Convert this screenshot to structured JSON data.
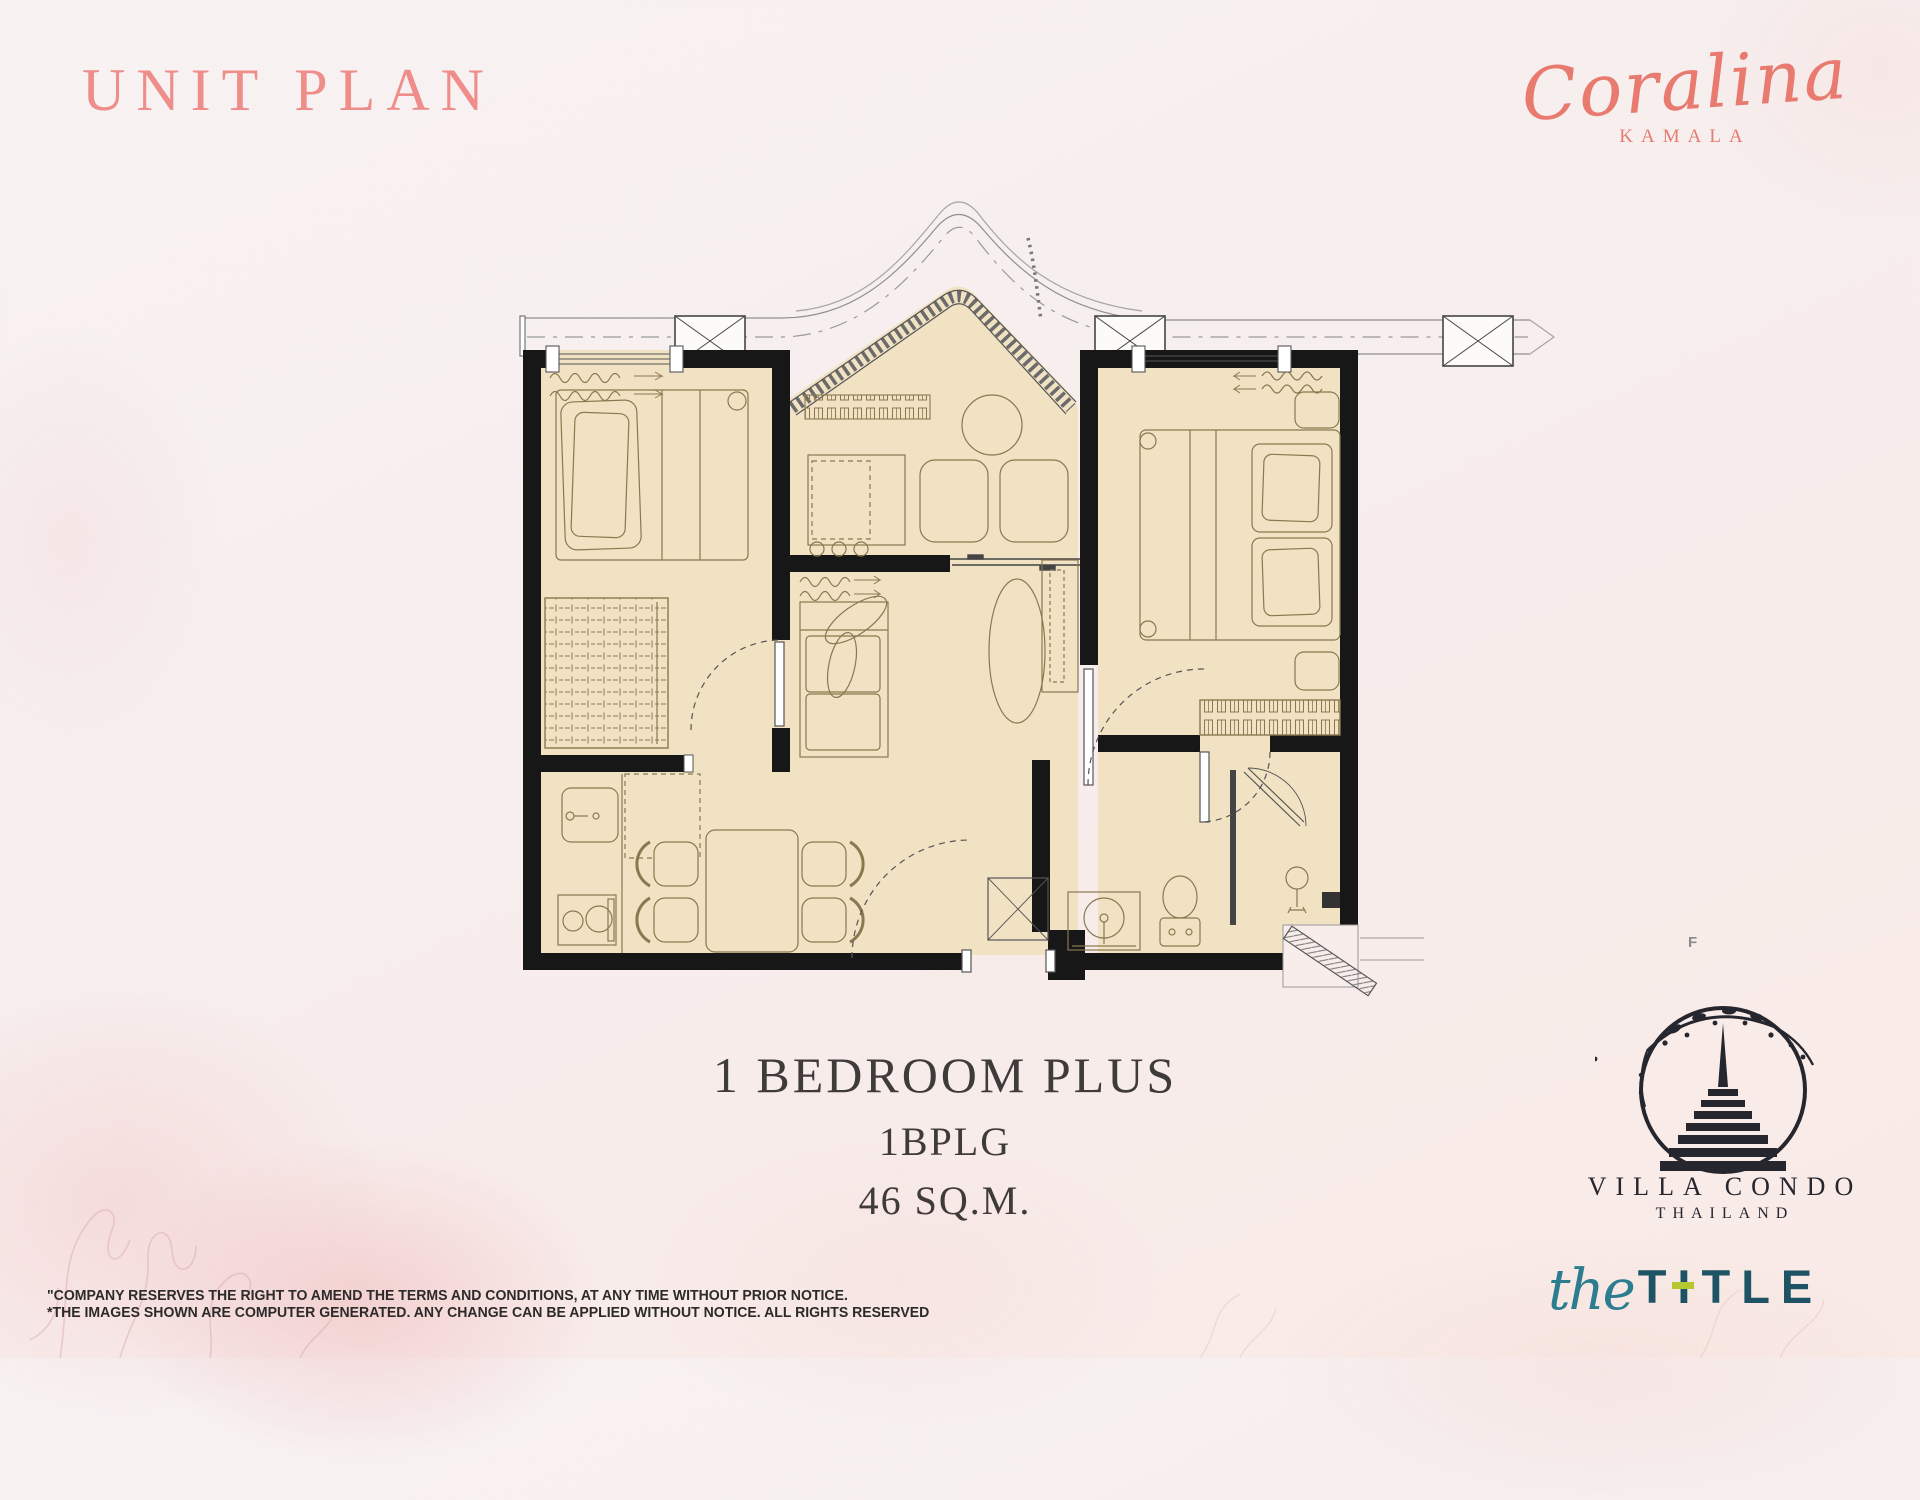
{
  "page": {
    "title_label": "UNIT PLAN",
    "floor_marker": "F"
  },
  "brand": {
    "name": "Coralina",
    "location": "KAMALA"
  },
  "unit": {
    "name": "1 BEDROOM PLUS",
    "code": "1BPLG",
    "area": "46 SQ.M."
  },
  "disclaimer": {
    "line1": "\"COMPANY RESERVES THE RIGHT TO AMEND THE TERMS AND CONDITIONS, AT ANY TIME WITHOUT PRIOR NOTICE.",
    "line2": "*THE IMAGES SHOWN ARE COMPUTER GENERATED. ANY CHANGE CAN BE APPLIED WITHOUT NOTICE. ALL RIGHTS RESERVED"
  },
  "developer": {
    "villa_condo": {
      "line1": "VILLA CONDO",
      "line2": "THAILAND"
    },
    "the_title": {
      "script": "the",
      "caps": "TITLE"
    }
  },
  "colors": {
    "accent_coral": "#ee8d89",
    "script_coral": "#e87a70",
    "heading_dark": "#3f3b3b",
    "teal": "#1d5364",
    "lime": "#b5c832",
    "floor": "#f1e2c3",
    "wall": "#171717",
    "furniture_line": "#8a784f"
  },
  "floor_plan": {
    "elements": [
      "balcony",
      "bedroom",
      "bedroom-plus",
      "living-area",
      "kitchen",
      "dining-area",
      "bathroom",
      "entrance",
      "single-bed",
      "double-bed",
      "wardrobe",
      "sofa",
      "coffee-table",
      "round-table",
      "desk",
      "dining-table",
      "sink",
      "stove",
      "refrigerator",
      "washing-machine",
      "toilet",
      "shower",
      "air-conditioner",
      "sliding-door"
    ]
  }
}
